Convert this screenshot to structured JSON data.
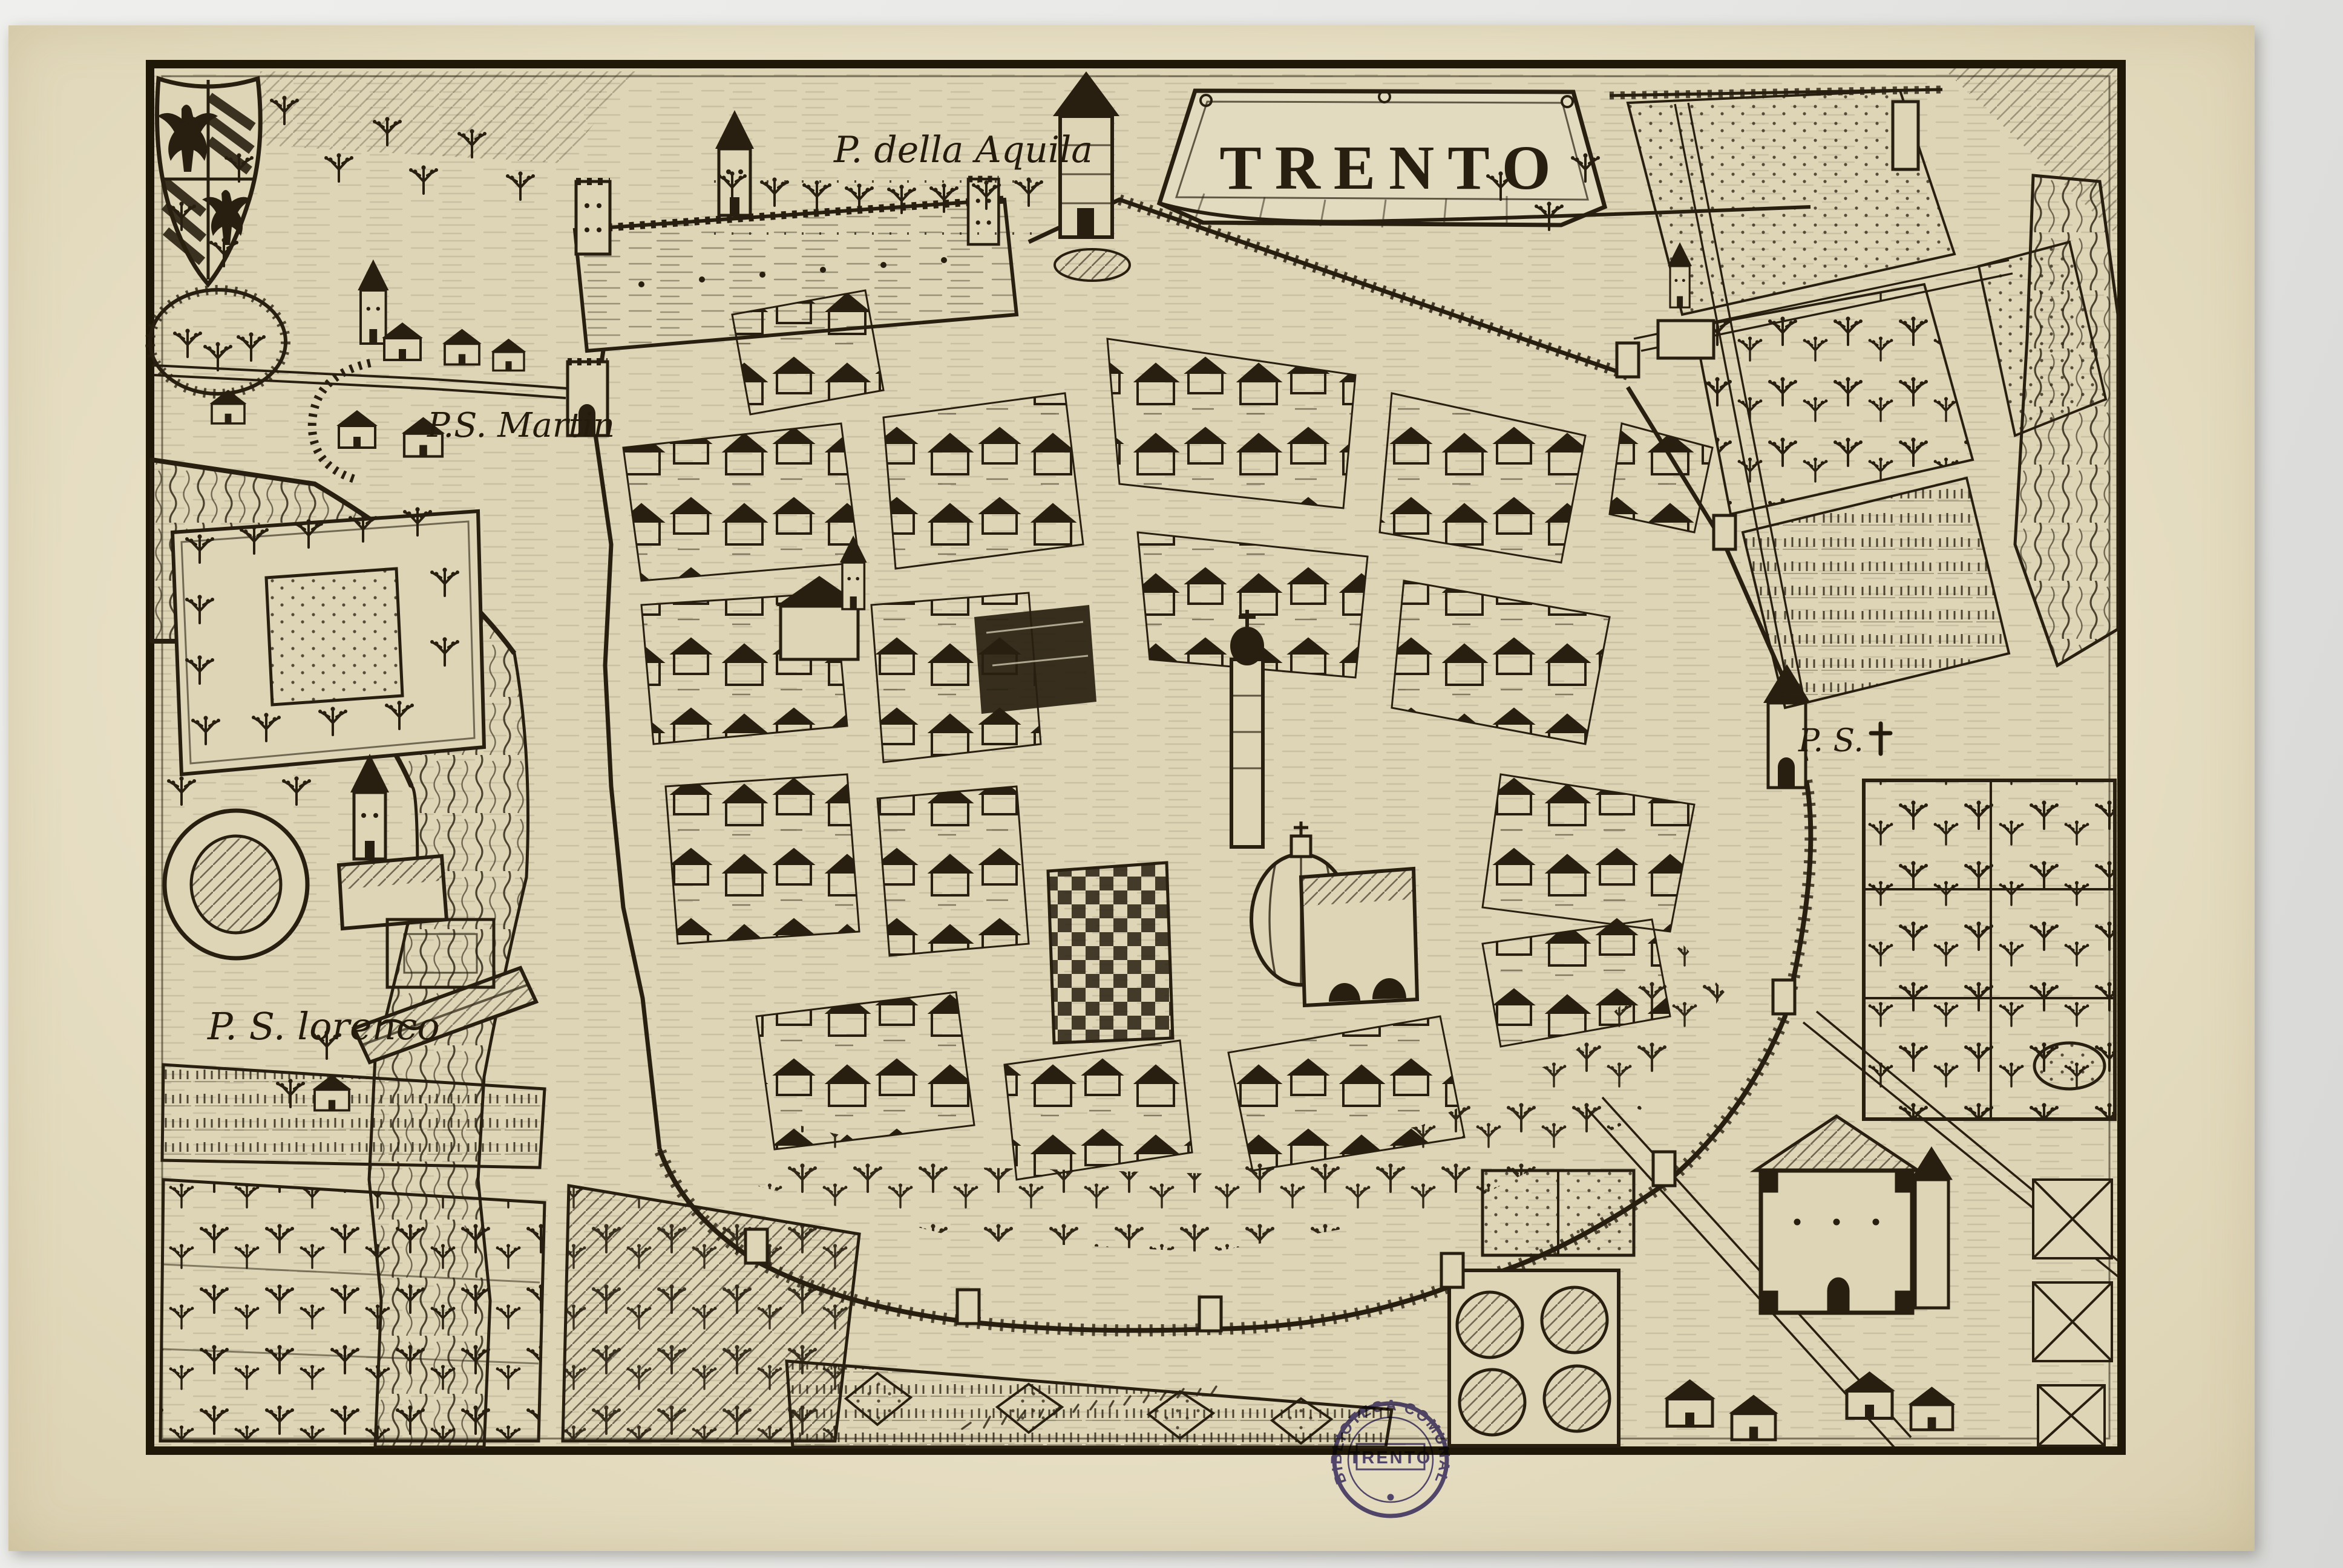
{
  "map": {
    "title": "TRENTO",
    "labels": {
      "porta_aquila": "P. della Aquila",
      "porta_s_martin": "P.S. Martin",
      "porta_s_lorenco": "P. S. lorenco",
      "porta_s_cross": "P. S."
    },
    "stamp": {
      "ring_text": "BIBLIOTECA COMUNALE",
      "center_text": "TRENTO"
    },
    "colors": {
      "paper_margin": "#e8e0c6",
      "plate_ground": "#ded5b6",
      "ink": "#281f10",
      "stamp_ink": "#3d3278"
    }
  }
}
